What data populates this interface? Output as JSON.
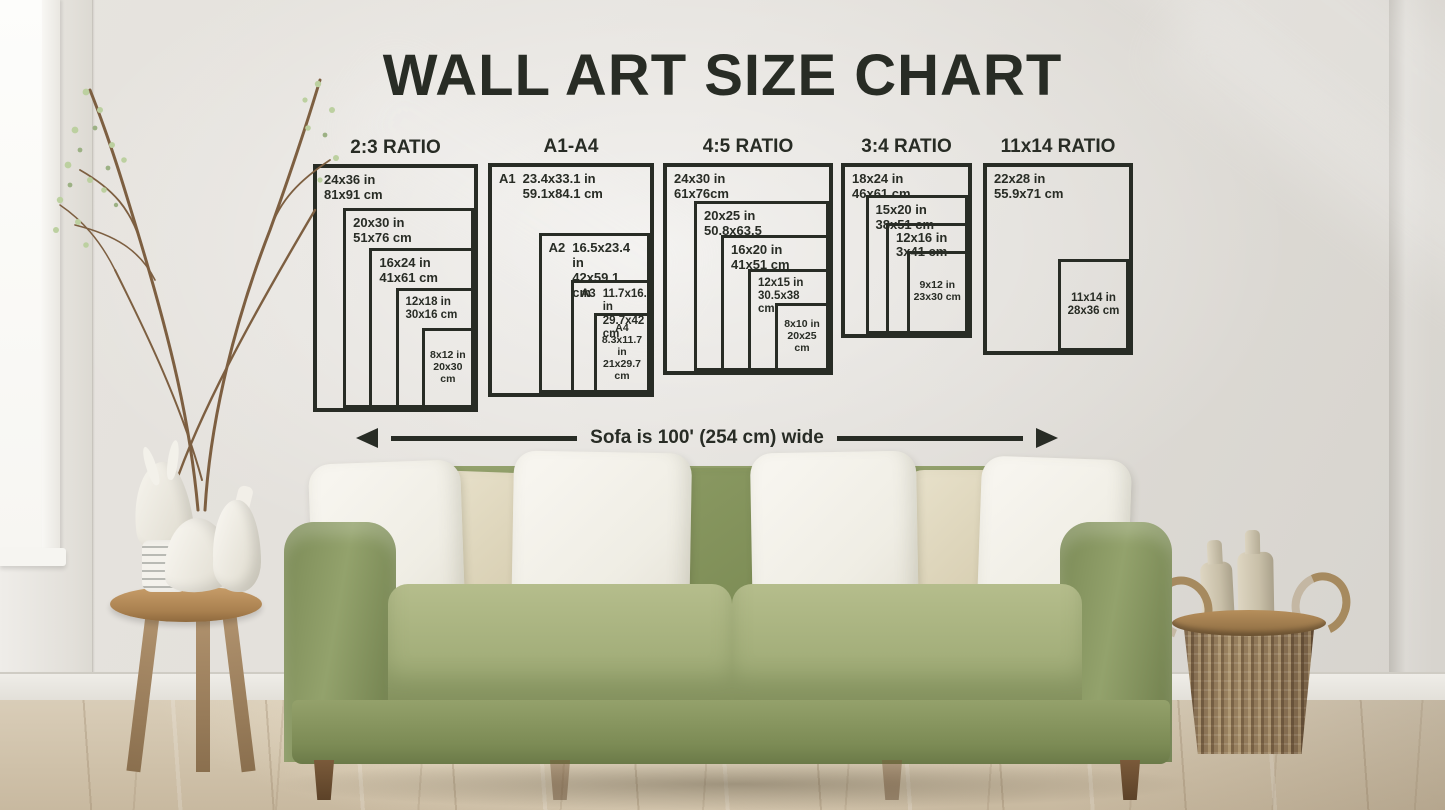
{
  "title": "WALL ART SIZE CHART",
  "arrow_label": "Sofa is 100' (254 cm) wide",
  "colors": {
    "chart_ink": "#282c25",
    "wall": "#e3e0db",
    "sofa_green": "#93a16c",
    "pillow_white": "#f3f1ea",
    "pillow_cream": "#ddd5bd",
    "floor_wood": "#d3c6b1",
    "table_wood": "#b28e60",
    "basket_wicker": "#8a7254"
  },
  "chart_data": {
    "type": "nested-size-chart",
    "groups": [
      {
        "header": "2:3 RATIO",
        "boxes": [
          {
            "w_in": 24,
            "h_in": 36,
            "label_in": "24x36 in",
            "label_cm": "81x91 cm",
            "label_pos": "top-left"
          },
          {
            "w_in": 20,
            "h_in": 30,
            "label_in": "20x30 in",
            "label_cm": "51x76 cm",
            "label_pos": "top-left"
          },
          {
            "w_in": 16,
            "h_in": 24,
            "label_in": "16x24 in",
            "label_cm": "41x61 cm",
            "label_pos": "top-left"
          },
          {
            "w_in": 12,
            "h_in": 18,
            "label_in": "12x18 in",
            "label_cm": "30x16 cm",
            "label_pos": "top-left"
          },
          {
            "w_in": 8,
            "h_in": 12,
            "label_in": "8x12 in",
            "label_cm": "20x30 cm",
            "label_pos": "center"
          }
        ]
      },
      {
        "header": "A1-A4",
        "boxes": [
          {
            "prefix": "A1",
            "w_in": 23.4,
            "h_in": 33.1,
            "label_in": "23.4x33.1 in",
            "label_cm": "59.1x84.1 cm",
            "label_pos": "top-left"
          },
          {
            "prefix": "A2",
            "w_in": 16.5,
            "h_in": 23.4,
            "label_in": "16.5x23.4 in",
            "label_cm": "42x59.1 cm",
            "label_pos": "top-left"
          },
          {
            "prefix": "A3",
            "w_in": 11.7,
            "h_in": 16.5,
            "label_in": "11.7x16.5 in",
            "label_cm": "29.7x42 cm",
            "label_pos": "top-left"
          },
          {
            "prefix": "A4",
            "w_in": 8.3,
            "h_in": 11.7,
            "label_in": "8.3x11.7 in",
            "label_cm": "21x29.7 cm",
            "label_pos": "center"
          }
        ]
      },
      {
        "header": "4:5 RATIO",
        "boxes": [
          {
            "w_in": 24,
            "h_in": 30,
            "label_in": "24x30 in",
            "label_cm": "61x76cm",
            "label_pos": "top-left"
          },
          {
            "w_in": 20,
            "h_in": 25,
            "label_in": "20x25 in",
            "label_cm": "50.8x63.5",
            "label_pos": "top-left"
          },
          {
            "w_in": 16,
            "h_in": 20,
            "label_in": "16x20 in",
            "label_cm": "41x51 cm",
            "label_pos": "top-left"
          },
          {
            "w_in": 12,
            "h_in": 15,
            "label_in": "12x15 in",
            "label_cm": "30.5x38 cm",
            "label_pos": "top-left"
          },
          {
            "w_in": 8,
            "h_in": 10,
            "label_in": "8x10 in",
            "label_cm": "20x25 cm",
            "label_pos": "center"
          }
        ]
      },
      {
        "header": "3:4 RATIO",
        "boxes": [
          {
            "w_in": 18,
            "h_in": 24,
            "label_in": "18x24 in",
            "label_cm": "46x61 cm",
            "label_pos": "top-left"
          },
          {
            "w_in": 15,
            "h_in": 20,
            "label_in": "15x20 in",
            "label_cm": "38x51 cm",
            "label_pos": "top-left"
          },
          {
            "w_in": 12,
            "h_in": 16,
            "label_in": "12x16 in",
            "label_cm": "3x41 cm",
            "label_pos": "top-left"
          },
          {
            "w_in": 9,
            "h_in": 12,
            "label_in": "9x12 in",
            "label_cm": "23x30 cm",
            "label_pos": "center"
          }
        ]
      },
      {
        "header": "11x14 RATIO",
        "boxes": [
          {
            "w_in": 22,
            "h_in": 28,
            "label_in": "22x28 in",
            "label_cm": "55.9x71 cm",
            "label_pos": "top-left"
          },
          {
            "w_in": 11,
            "h_in": 14,
            "label_in": "11x14 in",
            "label_cm": "28x36 cm",
            "label_pos": "center"
          }
        ]
      }
    ]
  }
}
